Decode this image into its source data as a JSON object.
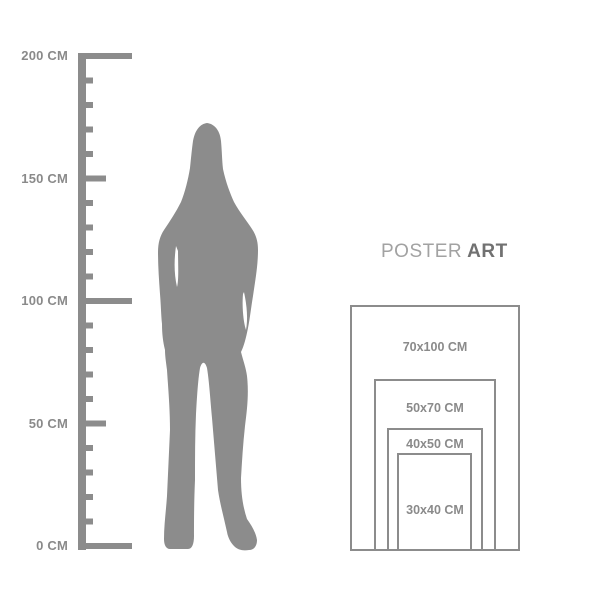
{
  "ruler": {
    "unit": "CM",
    "tick_interval_cm": 10,
    "labels": [
      "200 CM",
      "150 CM",
      "100 CM",
      "50 CM",
      "0 CM"
    ]
  },
  "figure": {
    "description": "gray standing woman silhouette used as height reference"
  },
  "brand": {
    "poster": "POSTER",
    "art": "ART"
  },
  "poster_sizes": [
    {
      "label": "70x100 CM"
    },
    {
      "label": "50x70 CM"
    },
    {
      "label": "40x50 CM"
    },
    {
      "label": "30x40 CM"
    }
  ],
  "colors": {
    "shape_gray": "#8c8c8c",
    "label_gray": "#8a8a8a",
    "brand_light_gray": "#a2a2a2",
    "brand_dark_gray": "#717171",
    "background": "#ffffff"
  }
}
